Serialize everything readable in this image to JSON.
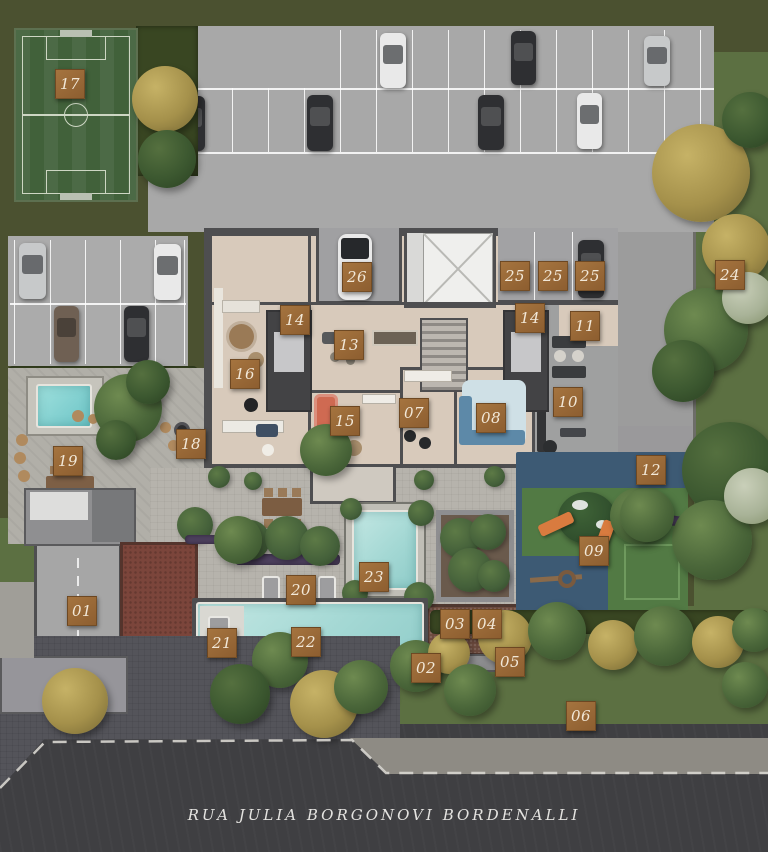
{
  "site_plan": {
    "street_label": "RUA JULIA BORGONOVI BORDENALLI",
    "colors": {
      "olive": "#4b5130",
      "lawn": "#5c7042",
      "marker": "#8d5e30",
      "markertext": "#f2e8d8",
      "asphalt": "#3f3f42",
      "pool_water": "#a4d8d4",
      "field_green": "#41613a"
    },
    "markers": [
      {
        "num": "01",
        "x": 82,
        "y": 611
      },
      {
        "num": "02",
        "x": 426,
        "y": 668
      },
      {
        "num": "03",
        "x": 455,
        "y": 624
      },
      {
        "num": "04",
        "x": 487,
        "y": 624
      },
      {
        "num": "05",
        "x": 510,
        "y": 662
      },
      {
        "num": "06",
        "x": 581,
        "y": 716
      },
      {
        "num": "07",
        "x": 414,
        "y": 413
      },
      {
        "num": "08",
        "x": 491,
        "y": 418
      },
      {
        "num": "09",
        "x": 594,
        "y": 551
      },
      {
        "num": "10",
        "x": 568,
        "y": 402
      },
      {
        "num": "11",
        "x": 585,
        "y": 326
      },
      {
        "num": "12",
        "x": 651,
        "y": 470
      },
      {
        "num": "13",
        "x": 349,
        "y": 345
      },
      {
        "num": "14",
        "x": 295,
        "y": 320
      },
      {
        "num": "14",
        "x": 530,
        "y": 318
      },
      {
        "num": "15",
        "x": 345,
        "y": 421
      },
      {
        "num": "16",
        "x": 245,
        "y": 374
      },
      {
        "num": "17",
        "x": 70,
        "y": 84
      },
      {
        "num": "18",
        "x": 191,
        "y": 444
      },
      {
        "num": "19",
        "x": 68,
        "y": 461
      },
      {
        "num": "20",
        "x": 301,
        "y": 590
      },
      {
        "num": "21",
        "x": 222,
        "y": 643
      },
      {
        "num": "22",
        "x": 306,
        "y": 642
      },
      {
        "num": "23",
        "x": 374,
        "y": 577
      },
      {
        "num": "24",
        "x": 730,
        "y": 275
      },
      {
        "num": "25",
        "x": 515,
        "y": 276
      },
      {
        "num": "25",
        "x": 553,
        "y": 276
      },
      {
        "num": "25",
        "x": 590,
        "y": 276
      },
      {
        "num": "26",
        "x": 357,
        "y": 277
      }
    ]
  }
}
